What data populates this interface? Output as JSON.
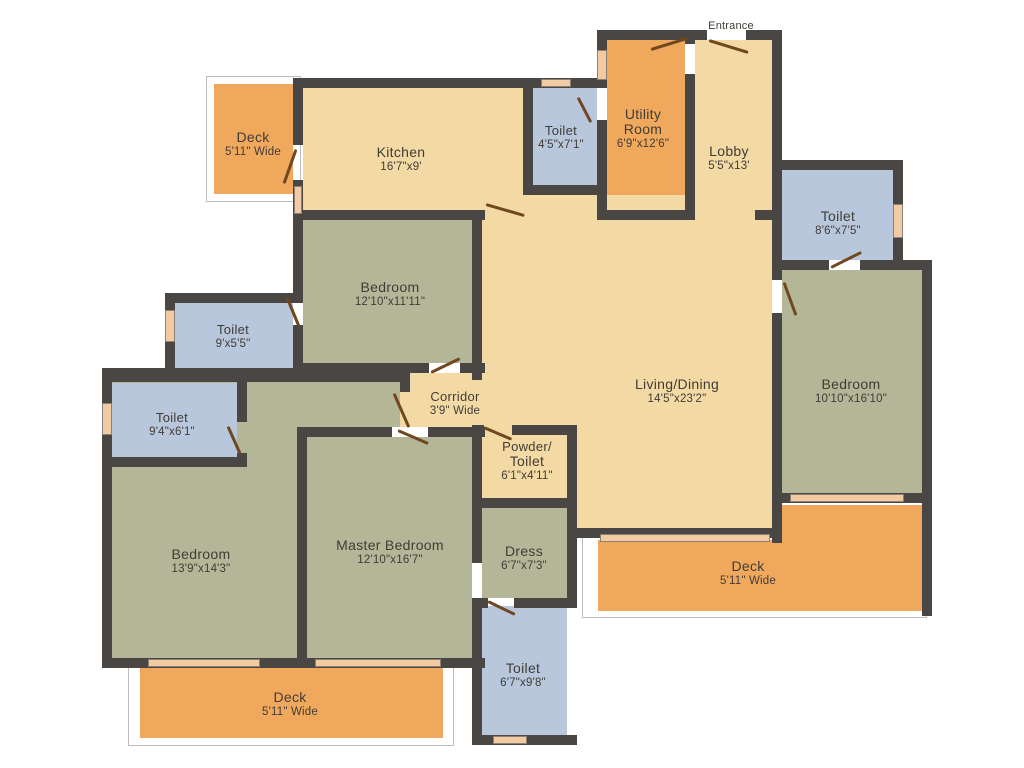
{
  "plan_title": "Apartment Floor Plan",
  "entrance_label": "Entrance",
  "rooms": [
    {
      "id": "deck-top-left",
      "name": "Deck",
      "dims": "5'11\" Wide"
    },
    {
      "id": "kitchen",
      "name": "Kitchen",
      "dims": "16'7\"x9'"
    },
    {
      "id": "toilet-top",
      "name": "Toilet",
      "dims": "4'5\"x7'1\""
    },
    {
      "id": "utility-room",
      "name": "Utility",
      "name2": "Room",
      "dims": "6'9\"x12'6\""
    },
    {
      "id": "lobby",
      "name": "Lobby",
      "dims": "5'5\"x13'"
    },
    {
      "id": "toilet-right",
      "name": "Toilet",
      "dims": "8'6\"x7'5\""
    },
    {
      "id": "bedroom-right",
      "name": "Bedroom",
      "dims": "10'10\"x16'10\""
    },
    {
      "id": "living-dining",
      "name": "Living/Dining",
      "dims": "14'5\"x23'2\""
    },
    {
      "id": "bedroom-middle",
      "name": "Bedroom",
      "dims": "12'10\"x11'11\""
    },
    {
      "id": "corridor",
      "name": "Corridor",
      "dims": "3'9\" Wide"
    },
    {
      "id": "toilet-mid-left",
      "name": "Toilet",
      "dims": "9'x5'5\""
    },
    {
      "id": "toilet-left",
      "name": "Toilet",
      "dims": "9'4\"x6'1\""
    },
    {
      "id": "bedroom-bottom-left",
      "name": "Bedroom",
      "dims": "13'9\"x14'3\""
    },
    {
      "id": "master-bedroom",
      "name": "Master Bedroom",
      "dims": "12'10\"x16'7\""
    },
    {
      "id": "powder-toilet",
      "name": "Powder/",
      "name2": "Toilet",
      "dims": "6'1\"x4'11\""
    },
    {
      "id": "dress",
      "name": "Dress",
      "dims": "6'7\"x7'3\""
    },
    {
      "id": "toilet-bottom",
      "name": "Toilet",
      "dims": "6'7\"x9'8\""
    },
    {
      "id": "deck-right",
      "name": "Deck",
      "dims": "5'11\" Wide"
    },
    {
      "id": "deck-bottom-left",
      "name": "Deck",
      "dims": "5'11\" Wide"
    }
  ],
  "colors": {
    "floor_cream": "#f3d9a4",
    "deck_orange": "#f0a95c",
    "toilet_blue": "#b9c7dd",
    "bedroom_green": "#b4b797",
    "wall_dark": "#4a4643",
    "door_brown": "#70481f",
    "window_peach": "#f2cba3",
    "text": "#403c37"
  }
}
